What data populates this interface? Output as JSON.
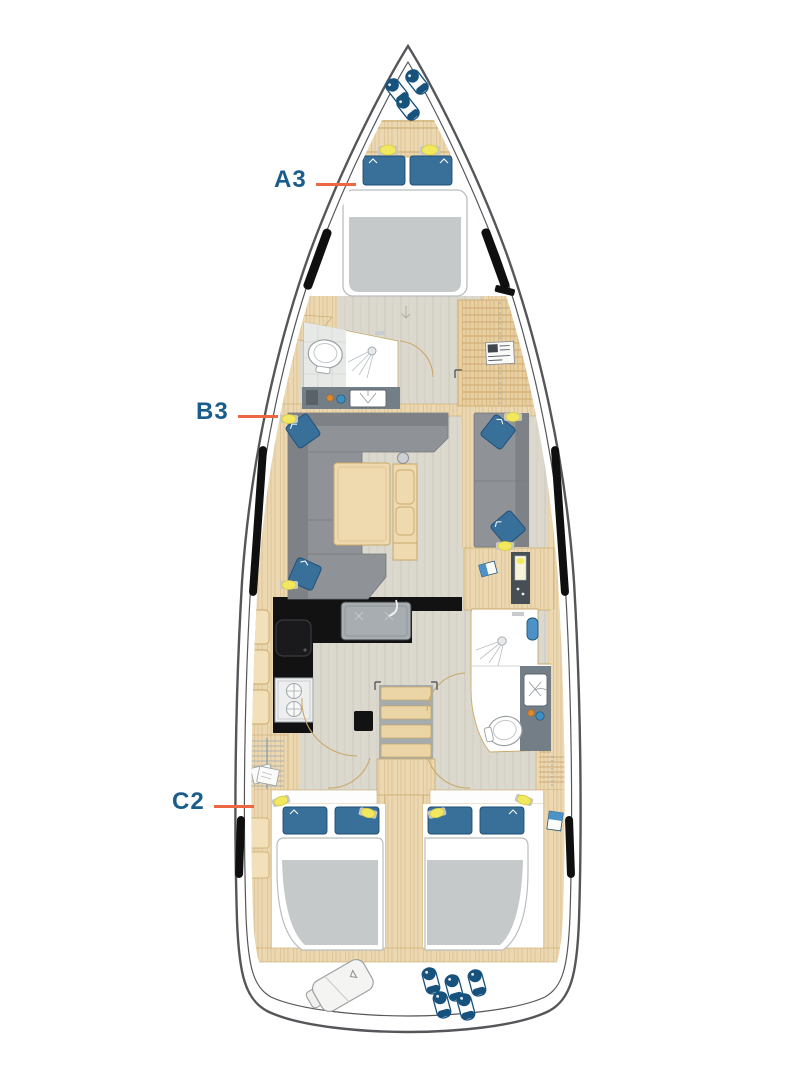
{
  "plan": {
    "labels": [
      {
        "id": "a3",
        "text": "A3"
      },
      {
        "id": "b3",
        "text": "B3"
      },
      {
        "id": "c2",
        "text": "C2"
      }
    ],
    "icons": [
      "bow-fenders-icon",
      "reading-light-icon",
      "pillow-icon",
      "double-berth-icon",
      "toilet-icon",
      "shower-head-icon",
      "sink-icon",
      "hull-window-icon",
      "sofa-icon",
      "salon-table-icon",
      "mast-post-icon",
      "galley-sink-icon",
      "stove-icon",
      "oven-burners-icon",
      "companionway-steps-icon",
      "electrical-panel-icon",
      "book-icon",
      "chart-icon",
      "hanging-locker-icon",
      "door-swing-icon",
      "sail-bag-icon",
      "stern-fenders-icon"
    ],
    "colors": {
      "label_text": "#1A5C8C",
      "pointer_line": "#ED6742",
      "hull_outline": "#55565A",
      "wood": "#ECD8B0",
      "wood_line": "#C9A96B",
      "floor_sole": "#DBD8CE",
      "upholstery_gray": "#8F9296",
      "mattress_gray": "#C6C9CA",
      "cushion_blue": "#38709A",
      "galley_black": "#121212",
      "light_yellow": "#F2E860",
      "fender_navy": "#17527D"
    }
  }
}
